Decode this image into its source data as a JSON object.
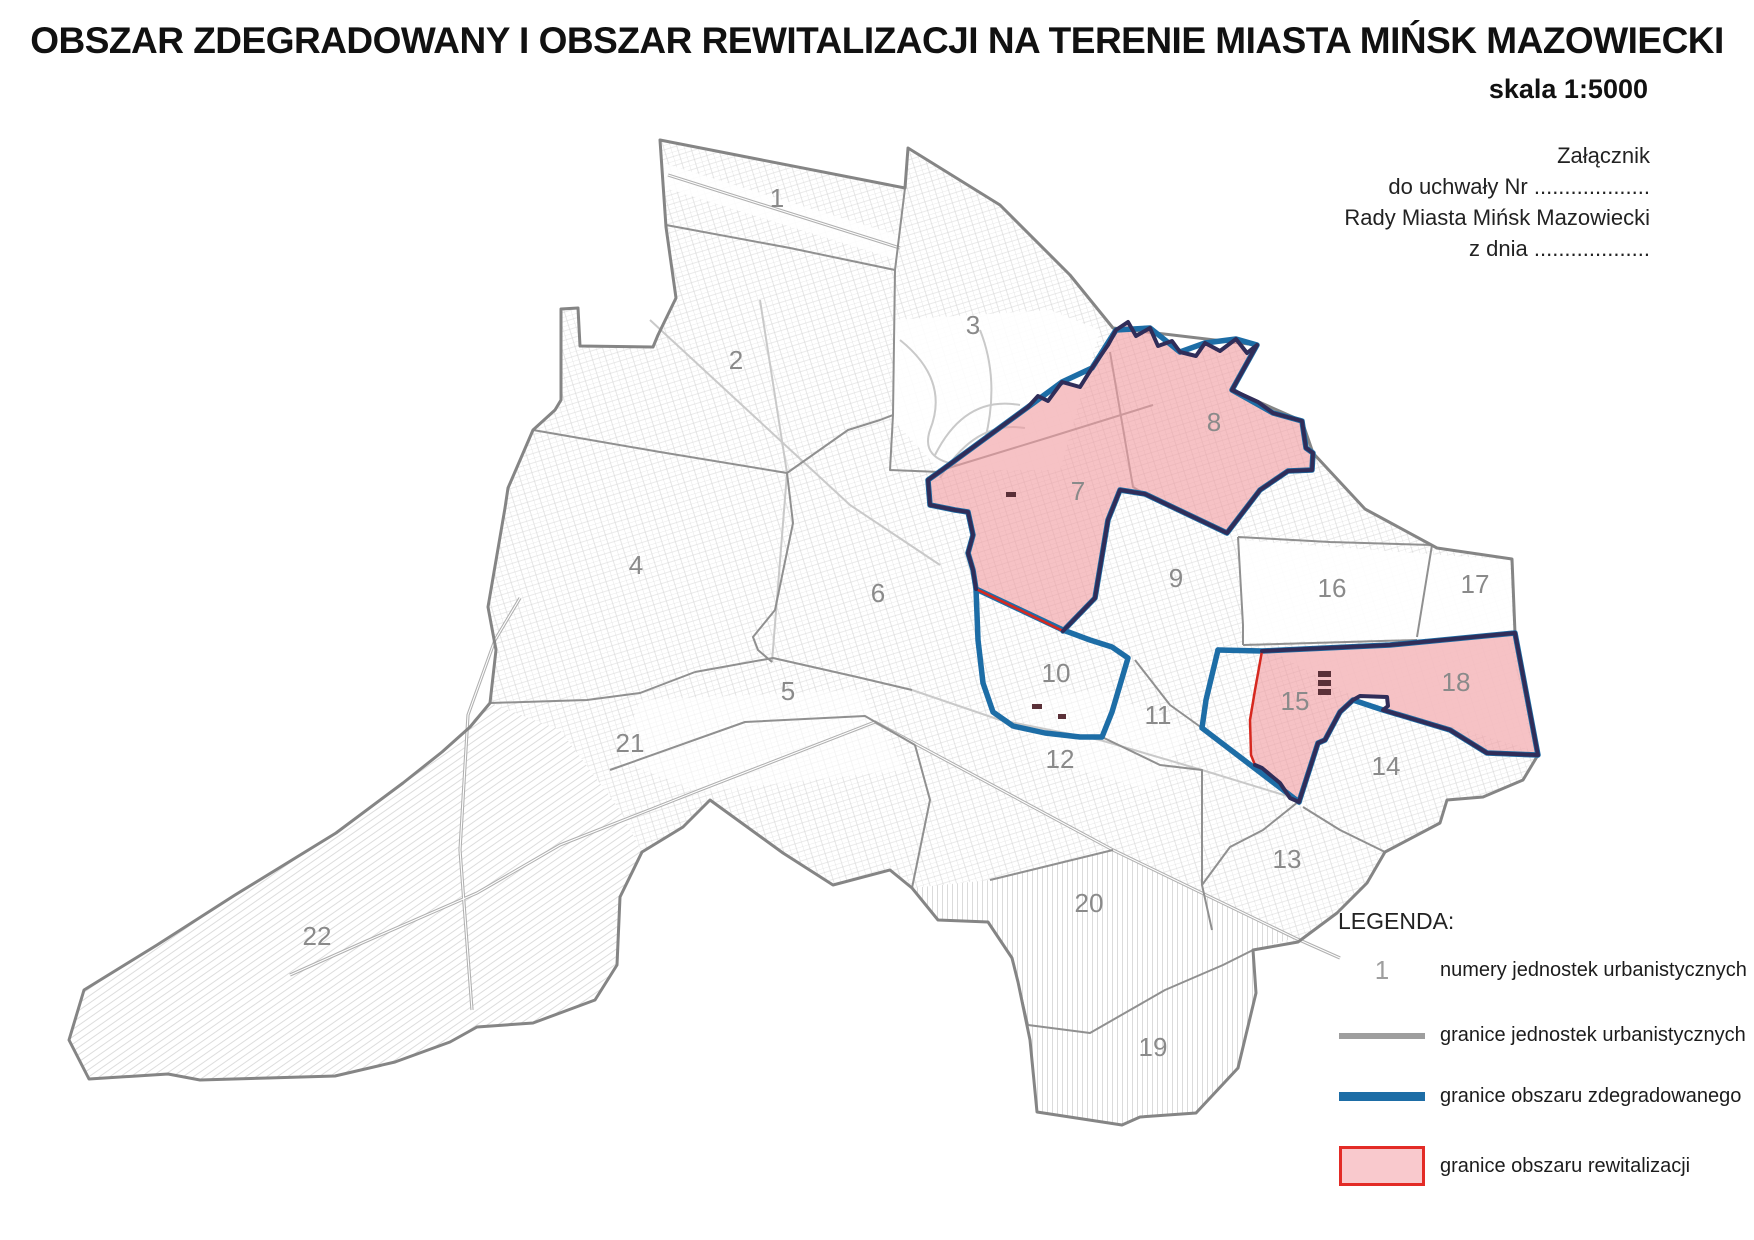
{
  "title": "OBSZAR ZDEGRADOWANY I OBSZAR REWITALIZACJI NA TERENIE MIASTA MIŃSK MAZOWIECKI",
  "scale_label": "skala 1:5000",
  "attachment_note": {
    "line1": "Załącznik",
    "line2": "do uchwały Nr ...................",
    "line3": "Rady Miasta Mińsk Mazowiecki",
    "line4": "z dnia ..................."
  },
  "legend": {
    "heading": "LEGENDA:",
    "items": [
      {
        "type": "number",
        "symbol": "1",
        "label": "numery jednostek urbanistycznych"
      },
      {
        "type": "gray-line",
        "label": "granice jednostek urbanistycznych"
      },
      {
        "type": "blue-line",
        "label": "granice obszaru zdegradowanego"
      },
      {
        "type": "pink-rect",
        "label": "granice obszaru rewitalizacji"
      }
    ]
  },
  "map": {
    "units": [
      {
        "label": "1",
        "x": 777,
        "y": 207
      },
      {
        "label": "2",
        "x": 736,
        "y": 369
      },
      {
        "label": "3",
        "x": 973,
        "y": 334
      },
      {
        "label": "4",
        "x": 636,
        "y": 574
      },
      {
        "label": "5",
        "x": 788,
        "y": 700
      },
      {
        "label": "6",
        "x": 878,
        "y": 602
      },
      {
        "label": "7",
        "x": 1078,
        "y": 500
      },
      {
        "label": "8",
        "x": 1214,
        "y": 431
      },
      {
        "label": "9",
        "x": 1176,
        "y": 587
      },
      {
        "label": "10",
        "x": 1056,
        "y": 682
      },
      {
        "label": "11",
        "x": 1158,
        "y": 724
      },
      {
        "label": "12",
        "x": 1060,
        "y": 768
      },
      {
        "label": "13",
        "x": 1287,
        "y": 868
      },
      {
        "label": "14",
        "x": 1386,
        "y": 775
      },
      {
        "label": "15",
        "x": 1295,
        "y": 710
      },
      {
        "label": "16",
        "x": 1332,
        "y": 597
      },
      {
        "label": "17",
        "x": 1475,
        "y": 593
      },
      {
        "label": "18",
        "x": 1456,
        "y": 691
      },
      {
        "label": "19",
        "x": 1153,
        "y": 1056
      },
      {
        "label": "20",
        "x": 1089,
        "y": 912
      },
      {
        "label": "21",
        "x": 630,
        "y": 752
      },
      {
        "label": "22",
        "x": 317,
        "y": 945
      }
    ]
  },
  "colors": {
    "unit_number_gray": "#8a8a8a",
    "unit_boundary_gray": "#9e9e9e",
    "degraded_blue": "#1d6da6",
    "revitalization_red": "#e32b26",
    "revitalization_pink": "#f9c9cd",
    "revitalization_dark_outline": "#302d59"
  }
}
